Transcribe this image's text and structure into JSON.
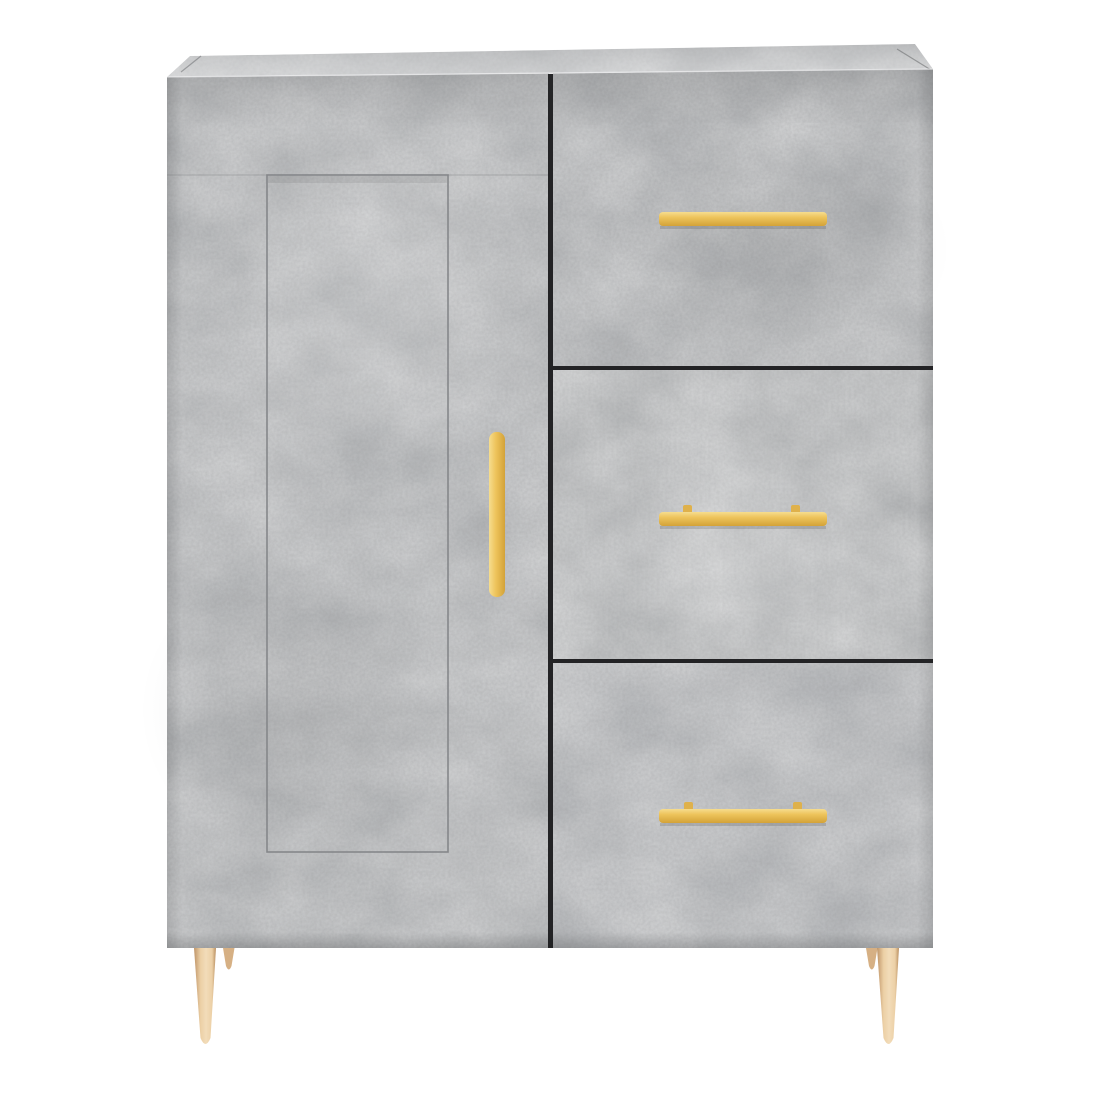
{
  "scene": {
    "type": "product-photo",
    "description": "Grey concrete-effect sideboard cabinet with one hinged door on the left, three drawers on the right, brass-gold bar handles and four tapered brass-gold legs, photographed front-on against a plain white background.",
    "background_color": "#ffffff"
  },
  "cabinet": {
    "parts": {
      "door": "hinged door with recessed rectangular panel and vertical brass handle",
      "drawer_1": "top drawer with horizontal brass bar handle",
      "drawer_2": "middle drawer with horizontal brass bar handle",
      "drawer_3": "bottom drawer with horizontal brass bar handle",
      "legs": "four tapered brass-gold legs, two front and two rear partially visible"
    },
    "colors": {
      "concrete_base": "#afb1b3",
      "concrete_door": "#aeb0b2",
      "concrete_drawer1": "#acaeb0",
      "concrete_drawer2": "#b0b2b4",
      "concrete_drawer3": "#aeb0b3",
      "concrete_top": "#c1c3c5",
      "seam": "#85878a",
      "gap_dark": "#232325",
      "edge_highlight": "#f2f3f4",
      "handle_hi": "#f6dd8f",
      "handle_mid": "#eec45c",
      "handle_lo": "#d3a238",
      "handle_post": "#dfb14b",
      "leg_edge": "#bf9468",
      "leg_mid": "#ecd0a6",
      "leg_hi": "#f2dcb9",
      "leg_lo": "#b98e60",
      "leg_rear": "#d6b084"
    }
  }
}
